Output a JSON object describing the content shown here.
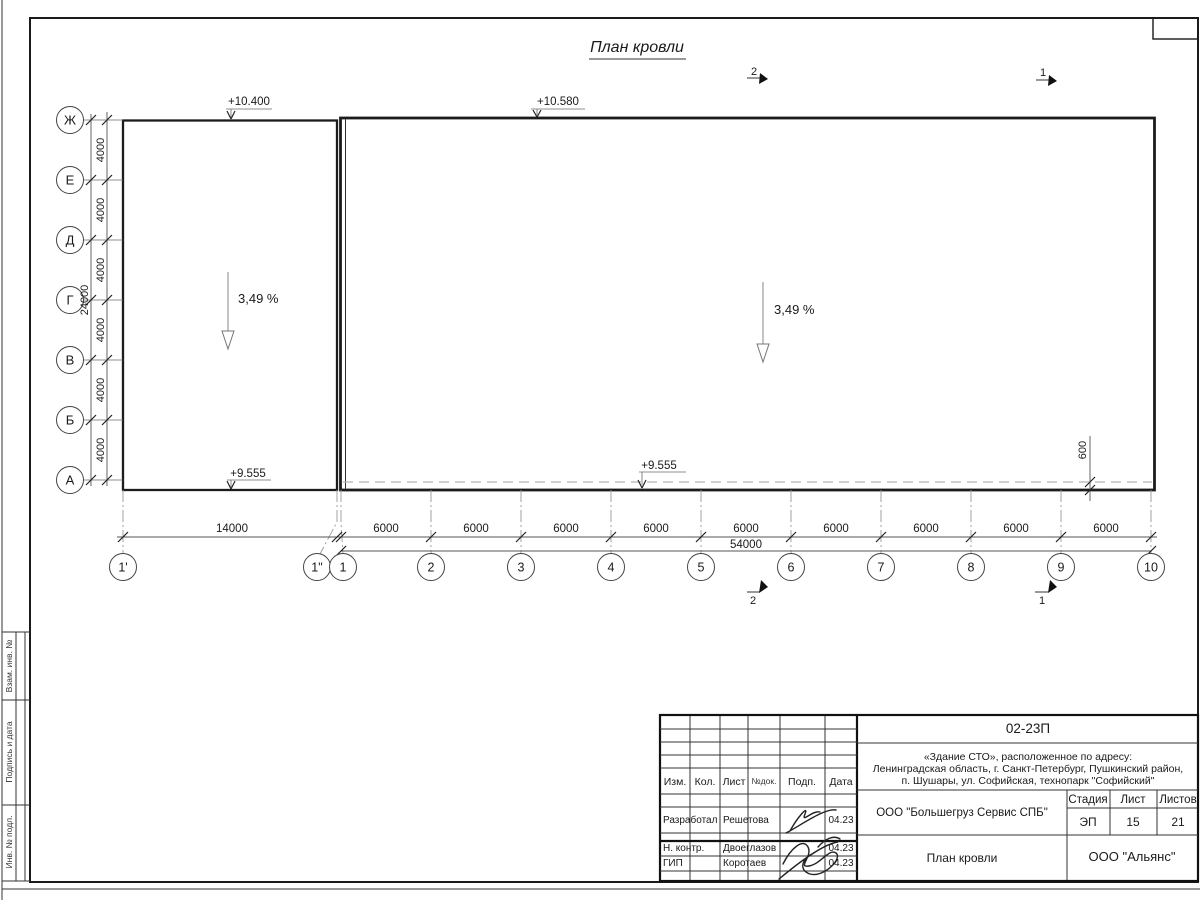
{
  "drawing_title": "План кровли",
  "axes": {
    "left": [
      "Ж",
      "Е",
      "Д",
      "Г",
      "В",
      "Б",
      "А"
    ],
    "bottom": [
      "1'",
      "1\"",
      "1",
      "2",
      "3",
      "4",
      "5",
      "6",
      "7",
      "8",
      "9",
      "10"
    ]
  },
  "dimensions": {
    "left_segments": [
      "4000",
      "4000",
      "4000",
      "4000",
      "4000",
      "4000"
    ],
    "left_total": "24000",
    "bottom_segments": [
      "14000",
      "6000",
      "6000",
      "6000",
      "6000",
      "6000",
      "6000",
      "6000",
      "6000",
      "6000"
    ],
    "bottom_total": "54000",
    "roof_edge_offset": "600"
  },
  "elevations": {
    "left_roof_top": "+10.400",
    "main_roof_top": "+10.580",
    "left_roof_bottom": "+9.555",
    "main_roof_bottom": "+9.555"
  },
  "slopes": {
    "left": "3,49 %",
    "right": "3,49 %"
  },
  "section_marks": {
    "top_left": "2",
    "top_right": "1",
    "bottom_left": "2",
    "bottom_right": "1"
  },
  "frame_strip": {
    "labels": [
      "Взам. инв. №",
      "Подпись и дата",
      "Инв. № подл."
    ]
  },
  "title_block": {
    "doc_number": "02-23П",
    "project_line1": "«Здание СТО», расположенное по адресу:",
    "project_line2": "Ленинградская область, г. Санкт-Петербург, Пушкинский район,",
    "project_line3": "п. Шушары, ул. Софийская, технопарк \"Софийский\"",
    "headers": {
      "izm": "Изм.",
      "kol": "Кол.",
      "list": "Лист",
      "ndok": "№док.",
      "podp": "Подп.",
      "data": "Дата"
    },
    "rows": [
      {
        "role": "Разработал",
        "name": "Решетова",
        "date": "04.23"
      },
      {
        "role": "Н. контр.",
        "name": "Двоеглазов",
        "date": "04.23"
      },
      {
        "role": "ГИП",
        "name": "Коротаев",
        "date": "04.23"
      }
    ],
    "client": "ООО \"Большегруз Сервис СПБ\"",
    "stage_label": "Стадия",
    "sheet_label": "Лист",
    "sheets_label": "Листов",
    "stage": "ЭП",
    "sheet": "15",
    "sheets": "21",
    "sheet_title": "План кровли",
    "contractor": "ООО \"Альянс\""
  }
}
